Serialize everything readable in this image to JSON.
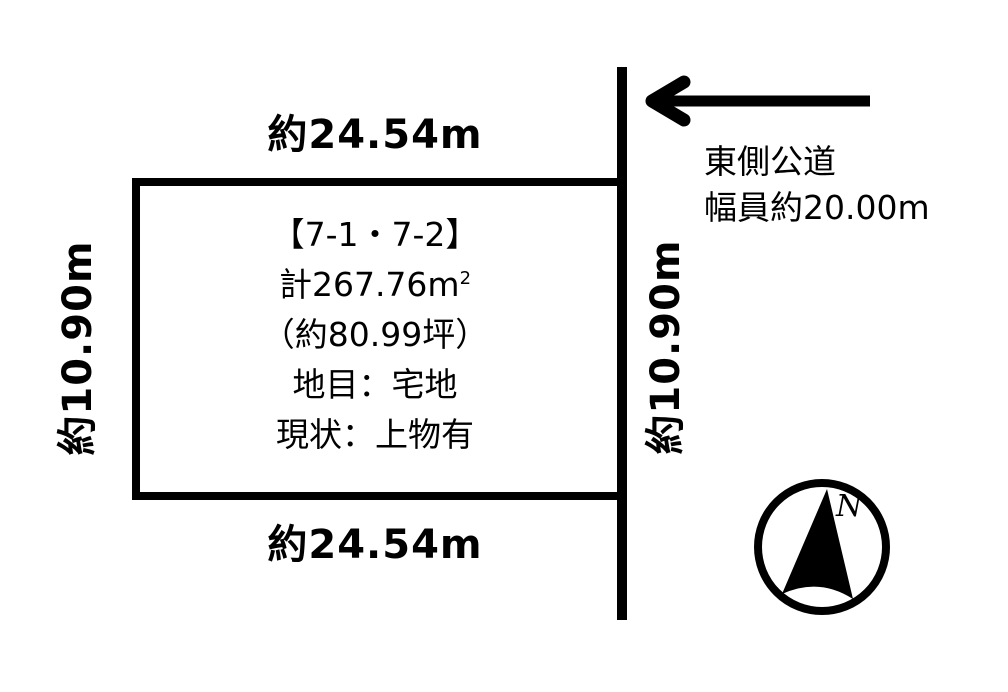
{
  "page": {
    "background_color": "#ffffff",
    "ink_color": "#000000"
  },
  "parcel": {
    "dimensions": {
      "top": "約24.54m",
      "bottom": "約24.54m",
      "left": "約10.90m",
      "right": "約10.90m"
    },
    "info": {
      "lot_number": "【7-1・7-2】",
      "area_total": "計267.76m",
      "area_total_sup": "2",
      "area_tsubo": "（約80.99坪）",
      "land_category": "地目：宅地",
      "current_state": "現状：上物有"
    }
  },
  "road": {
    "name": "東側公道",
    "width": "幅員約20.00m"
  },
  "compass": {
    "north": "N"
  }
}
